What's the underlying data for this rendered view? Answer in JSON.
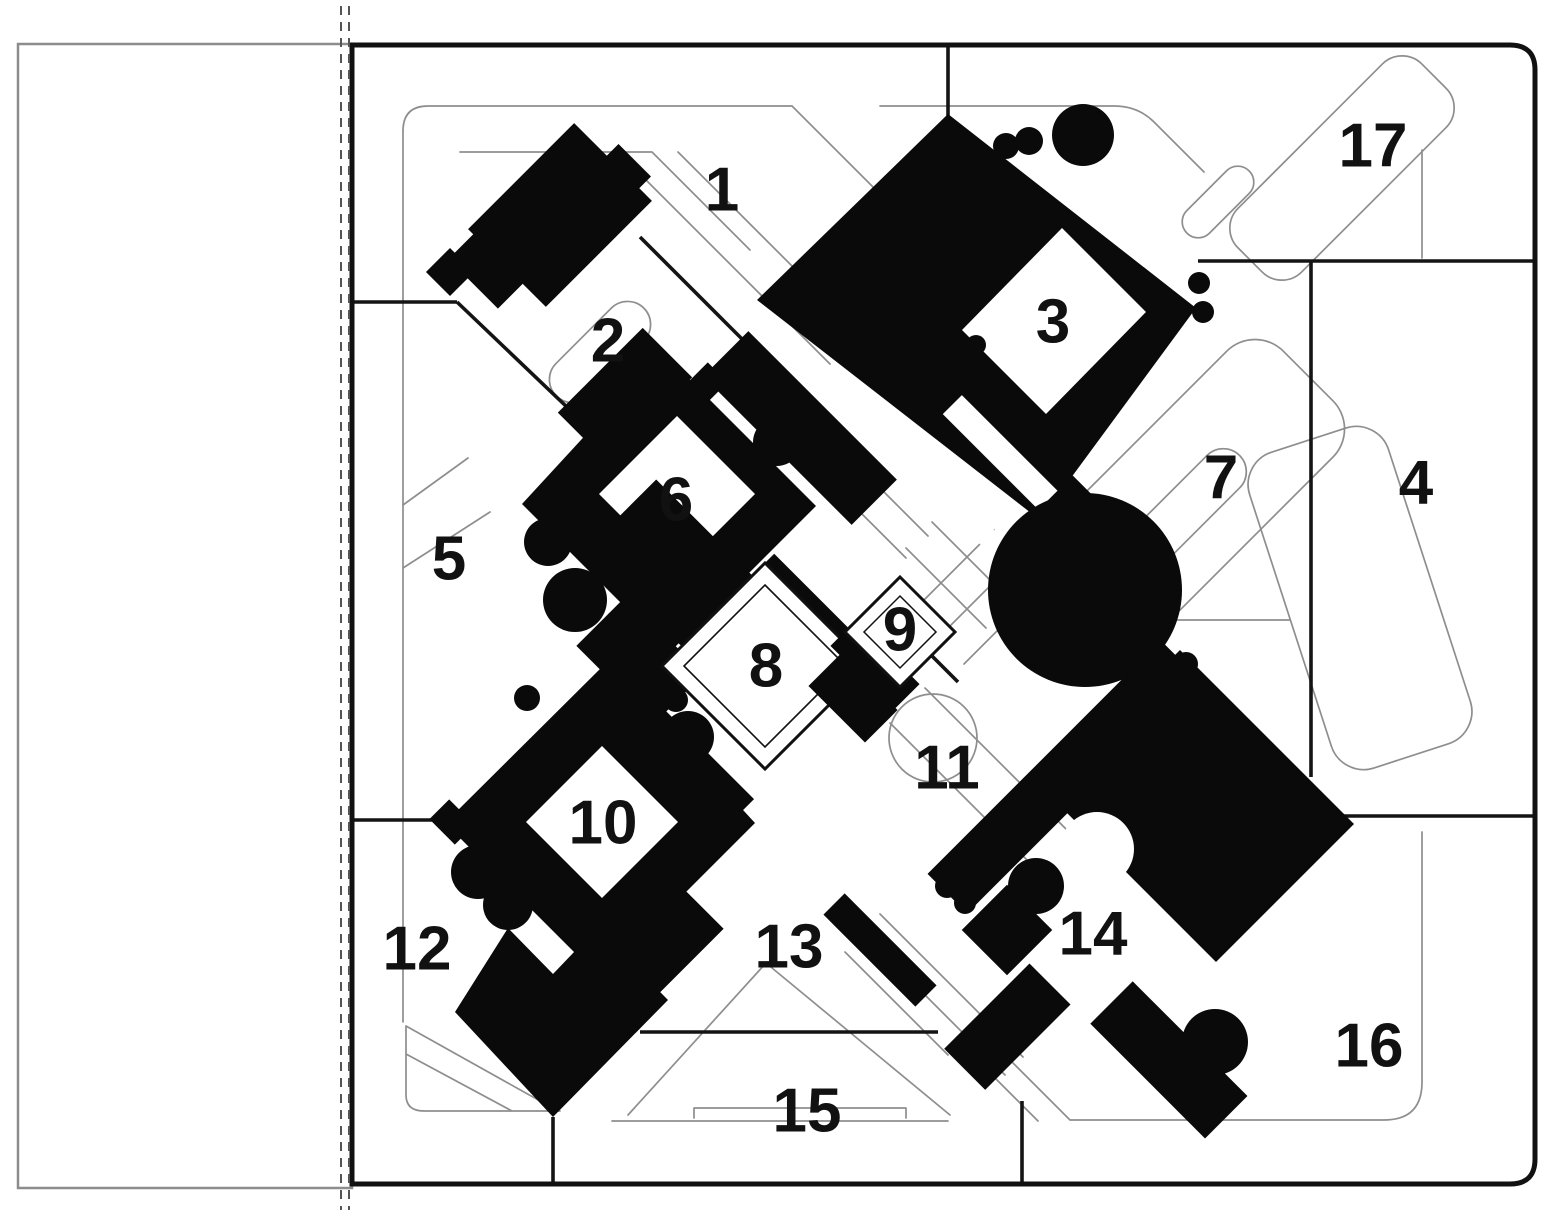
{
  "figure": {
    "kind": "figure-ground site plan",
    "zone_count": 17,
    "description": "Black building footprints on white ground, plan rotated 45 degrees, zones numbered 1-17, dashed cut line at left edge of plan frame"
  },
  "zones": [
    {
      "label": "1"
    },
    {
      "label": "2"
    },
    {
      "label": "3"
    },
    {
      "label": "4"
    },
    {
      "label": "5"
    },
    {
      "label": "6"
    },
    {
      "label": "7"
    },
    {
      "label": "8"
    },
    {
      "label": "9"
    },
    {
      "label": "10"
    },
    {
      "label": "11"
    },
    {
      "label": "12"
    },
    {
      "label": "13"
    },
    {
      "label": "14"
    },
    {
      "label": "15"
    },
    {
      "label": "16"
    },
    {
      "label": "17"
    }
  ],
  "colors": {
    "background": "#ffffff",
    "building_ink": "#0a0a0a",
    "line_ink": "#141414",
    "path_outline_gray": "#8e8e8e",
    "panel_outline_gray": "#8c8c8c",
    "dashed_cut_line": "#555555"
  }
}
